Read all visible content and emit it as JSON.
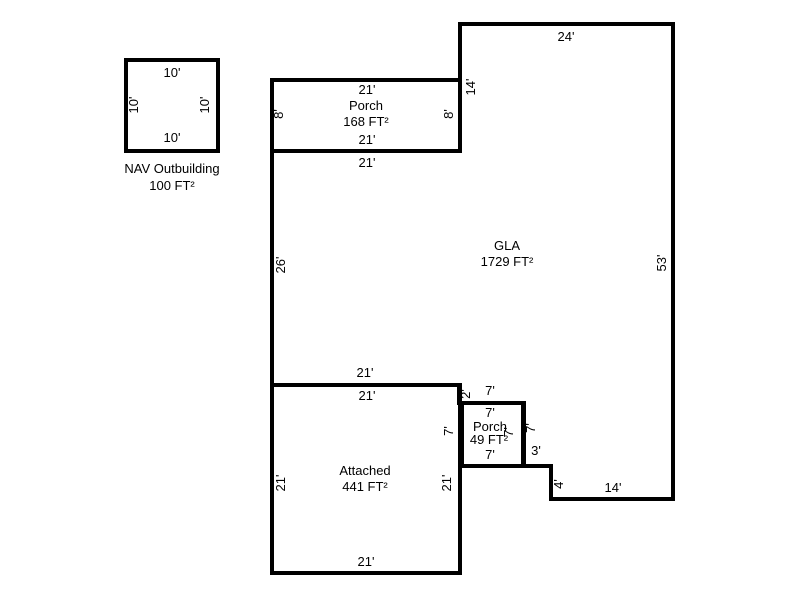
{
  "canvas": {
    "width": 800,
    "height": 600,
    "background": "#ffffff",
    "line_color": "#000000",
    "line_width": 4,
    "text_color": "#000000"
  },
  "figures": [
    {
      "name": "nav-outbuilding",
      "outline": {
        "type": "rect",
        "x": 126,
        "y": 60,
        "w": 92,
        "h": 91
      },
      "labels": [
        {
          "name": "dim-top",
          "text": "10'",
          "x": 172,
          "y": 73,
          "rot": 0
        },
        {
          "name": "dim-left",
          "text": "10'",
          "x": 134,
          "y": 105,
          "rot": -90
        },
        {
          "name": "dim-right",
          "text": "10'",
          "x": 205,
          "y": 105,
          "rot": -90
        },
        {
          "name": "dim-bottom",
          "text": "10'",
          "x": 172,
          "y": 138,
          "rot": 0
        },
        {
          "name": "caption-name",
          "text": "NAV Outbuilding",
          "x": 172,
          "y": 169,
          "rot": 0
        },
        {
          "name": "caption-area",
          "text": "100 FT²",
          "x": 172,
          "y": 186,
          "rot": 0
        }
      ]
    },
    {
      "name": "porch-168",
      "outline": {
        "type": "rect",
        "x": 272,
        "y": 80,
        "w": 188,
        "h": 71
      },
      "labels": [
        {
          "name": "dim-top",
          "text": "21'",
          "x": 367,
          "y": 90,
          "rot": 0
        },
        {
          "name": "room-name",
          "text": "Porch",
          "x": 366,
          "y": 106,
          "rot": 0
        },
        {
          "name": "room-area",
          "text": "168 FT²",
          "x": 366,
          "y": 122,
          "rot": 0
        },
        {
          "name": "dim-bottom",
          "text": "21'",
          "x": 367,
          "y": 140,
          "rot": 0
        },
        {
          "name": "dim-left",
          "text": "8'",
          "x": 279,
          "y": 114,
          "rot": -90
        },
        {
          "name": "dim-right",
          "text": "8'",
          "x": 449,
          "y": 114,
          "rot": -90
        }
      ]
    },
    {
      "name": "gla",
      "outline": {
        "type": "polygon",
        "points": [
          [
            460,
            24
          ],
          [
            673,
            24
          ],
          [
            673,
            499
          ],
          [
            551,
            499
          ],
          [
            551,
            466
          ],
          [
            524,
            466
          ],
          [
            524,
            403
          ],
          [
            459,
            403
          ],
          [
            459,
            385
          ],
          [
            272,
            385
          ],
          [
            272,
            151
          ],
          [
            460,
            151
          ]
        ]
      },
      "labels": [
        {
          "name": "dim-top",
          "text": "24'",
          "x": 566,
          "y": 37,
          "rot": 0
        },
        {
          "name": "dim-upper-left",
          "text": "14'",
          "x": 471,
          "y": 87,
          "rot": -90
        },
        {
          "name": "dim-top-left",
          "text": "21'",
          "x": 367,
          "y": 163,
          "rot": 0
        },
        {
          "name": "dim-left",
          "text": "26'",
          "x": 281,
          "y": 265,
          "rot": -90
        },
        {
          "name": "dim-right",
          "text": "53'",
          "x": 662,
          "y": 263,
          "rot": -90
        },
        {
          "name": "room-name",
          "text": "GLA",
          "x": 507,
          "y": 246,
          "rot": 0
        },
        {
          "name": "room-area",
          "text": "1729 FT²",
          "x": 507,
          "y": 262,
          "rot": 0
        },
        {
          "name": "dim-bottom-left",
          "text": "21'",
          "x": 365,
          "y": 373,
          "rot": 0
        },
        {
          "name": "dim-step",
          "text": "2'",
          "x": 466,
          "y": 394,
          "rot": -90
        },
        {
          "name": "dim-porch-top",
          "text": "7'",
          "x": 490,
          "y": 391,
          "rot": 0
        },
        {
          "name": "dim-porch-right",
          "text": "7'",
          "x": 531,
          "y": 428,
          "rot": -90
        },
        {
          "name": "dim-notch-across",
          "text": "3'",
          "x": 536,
          "y": 451,
          "rot": 0
        },
        {
          "name": "dim-notch-down",
          "text": "4'",
          "x": 559,
          "y": 484,
          "rot": -90
        },
        {
          "name": "dim-bottom",
          "text": "14'",
          "x": 613,
          "y": 488,
          "rot": 0
        }
      ]
    },
    {
      "name": "attached",
      "outline": {
        "type": "rect",
        "x": 272,
        "y": 385,
        "w": 188,
        "h": 188
      },
      "labels": [
        {
          "name": "dim-top",
          "text": "21'",
          "x": 367,
          "y": 396,
          "rot": 0
        },
        {
          "name": "room-name",
          "text": "Attached",
          "x": 365,
          "y": 471,
          "rot": 0
        },
        {
          "name": "room-area",
          "text": "441 FT²",
          "x": 365,
          "y": 487,
          "rot": 0
        },
        {
          "name": "dim-left",
          "text": "21'",
          "x": 281,
          "y": 483,
          "rot": -90
        },
        {
          "name": "dim-right",
          "text": "21'",
          "x": 447,
          "y": 483,
          "rot": -90
        },
        {
          "name": "dim-bottom",
          "text": "21'",
          "x": 366,
          "y": 562,
          "rot": 0
        }
      ]
    },
    {
      "name": "porch-49",
      "outline": {
        "type": "rect",
        "x": 462,
        "y": 403,
        "w": 61,
        "h": 63
      },
      "labels": [
        {
          "name": "dim-top",
          "text": "7'",
          "x": 490,
          "y": 413,
          "rot": 0
        },
        {
          "name": "room-name",
          "text": "Porch",
          "x": 490,
          "y": 427,
          "rot": 0
        },
        {
          "name": "room-area",
          "text": "49 FT²",
          "x": 489,
          "y": 440,
          "rot": 0
        },
        {
          "name": "dim-bottom",
          "text": "7'",
          "x": 490,
          "y": 455,
          "rot": 0
        },
        {
          "name": "dim-left",
          "text": "7'",
          "x": 449,
          "y": 431,
          "rot": -90
        },
        {
          "name": "dim-right",
          "text": "7'",
          "x": 509,
          "y": 432,
          "rot": -90
        }
      ]
    }
  ]
}
